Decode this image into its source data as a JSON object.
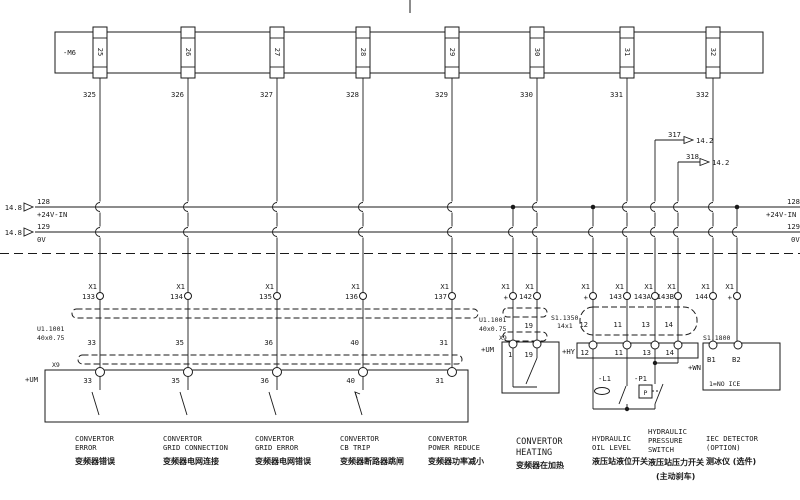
{
  "terminal_strip": {
    "label": "-M6",
    "terminals": [
      "25",
      "26",
      "27",
      "28",
      "29",
      "30",
      "31",
      "32"
    ]
  },
  "top_wires": [
    "325",
    "326",
    "327",
    "328",
    "329",
    "330",
    "331",
    "332"
  ],
  "bus": {
    "left_ref": "14.8",
    "p24_num": "128",
    "p24_name": "+24V-IN",
    "ov_num": "129",
    "ov_name": "0V",
    "right_p24_num": "128",
    "right_p24_name": "+24V-IN",
    "right_ov_num": "129",
    "right_ov_name": "0V"
  },
  "crossrefs": {
    "w317": "317",
    "w317_ref": "14.2",
    "w318": "318",
    "w318_ref": "14.2"
  },
  "x1": {
    "label": "X1",
    "pins_left": [
      "133",
      "134",
      "135",
      "136",
      "137"
    ]
  },
  "cable_left": {
    "name": "U1.1001",
    "spec": "40x0.75",
    "wires": [
      "33",
      "35",
      "36",
      "40",
      "31"
    ]
  },
  "x9_left": {
    "label": "X9",
    "location": "+UM",
    "pins": [
      "33",
      "35",
      "36",
      "40",
      "31"
    ]
  },
  "heating": {
    "x1_plus": "+",
    "x1_pin": "142",
    "cable_name": "U1.1001",
    "cable_spec": "40x0.75",
    "wire": "19",
    "box_label": "X9",
    "location": "+UM",
    "pin_left": "1",
    "pin_right": "19"
  },
  "hydraulic": {
    "x1_labels": [
      "+",
      "143",
      "143A",
      "143B"
    ],
    "cable_name": "S1.1350",
    "cable_spec": "14x1",
    "wires": [
      "12",
      "11",
      "13",
      "14"
    ],
    "location": "+HY",
    "pins": [
      "12",
      "11",
      "13",
      "14"
    ],
    "l1": "-L1",
    "p1": "-P1",
    "p_letter": "P"
  },
  "iec": {
    "x1_pin": "144",
    "x1_plus": "+",
    "device": "S1.1800",
    "location": "+WN",
    "pin_b1": "B1",
    "pin_b2": "B2",
    "note": "1=NO ICE"
  },
  "captions": {
    "c1": {
      "l1": "CONVERTOR",
      "l2": "ERROR",
      "zh": "变频器错误"
    },
    "c2": {
      "l1": "CONVERTOR",
      "l2": "GRID CONNECTION",
      "zh": "变频器电网连接"
    },
    "c3": {
      "l1": "CONVERTOR",
      "l2": "GRID ERROR",
      "zh": "变频器电网错误"
    },
    "c4": {
      "l1": "CONVERTOR",
      "l2": "CB TRIP",
      "zh": "变频器断路器跳闸"
    },
    "c5": {
      "l1": "CONVERTOR",
      "l2": "POWER REDUCE",
      "zh": "变频器功率减小"
    },
    "c6": {
      "l1": "CONVERTOR",
      "l2": "HEATING",
      "zh": "变频器在加热"
    },
    "c7": {
      "l1": "HYDRAULIC",
      "l2": "OIL LEVEL",
      "zh": "液压站液位开关"
    },
    "c8": {
      "l1": "HYDRAULIC",
      "l2": "PRESSURE",
      "l3": "SWITCH",
      "zh": "液压站压力开关",
      "zh2": "(主动刹车)"
    },
    "c9": {
      "l1": "IEC DETECTOR",
      "l2": "(OPTION)",
      "zh": "测冰仪 (选件)"
    }
  }
}
